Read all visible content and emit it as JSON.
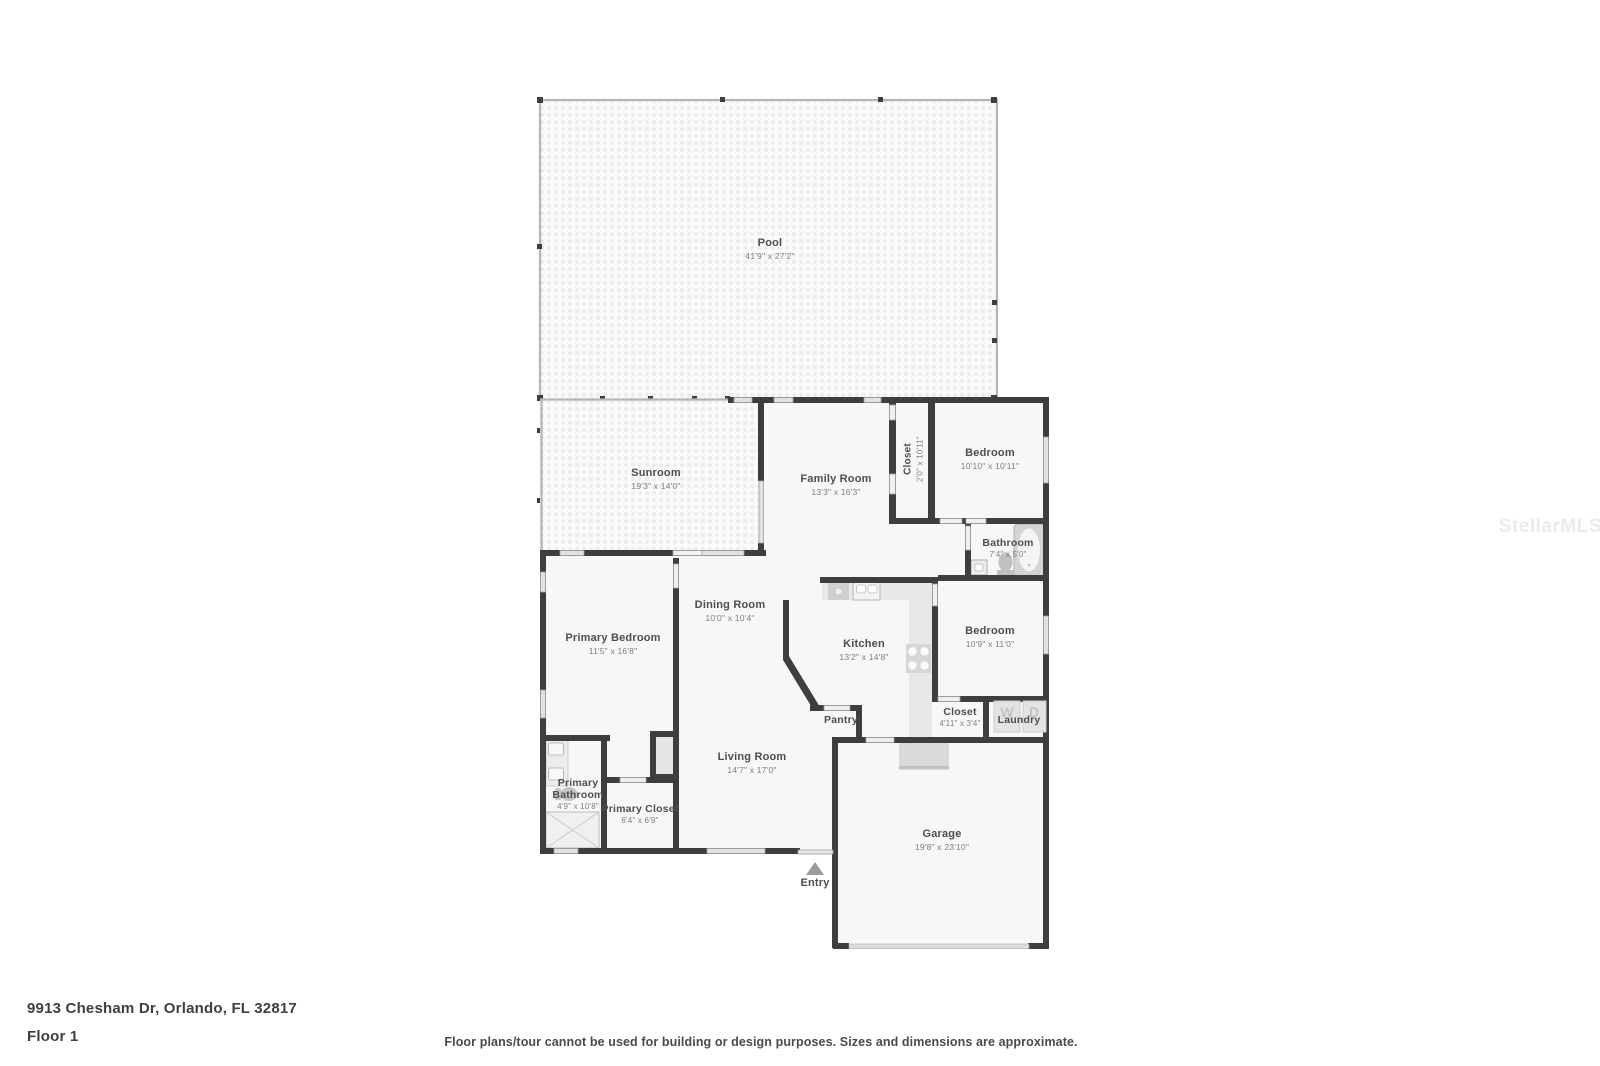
{
  "address": "9913 Chesham Dr, Orlando, FL 32817",
  "floor_label": "Floor 1",
  "disclaimer": "Floor plans/tour cannot be used for building or design purposes. Sizes and dimensions are approximate.",
  "watermark": "StellarMLS",
  "entry": {
    "label": "Entry"
  },
  "rooms": {
    "pool": {
      "name": "Pool",
      "dims": "41'9\" x 27'2\""
    },
    "sunroom": {
      "name": "Sunroom",
      "dims": "19'3\" x 14'0\""
    },
    "family_room": {
      "name": "Family Room",
      "dims": "13'3\" x 16'3\""
    },
    "hall_closet": {
      "name": "Closet",
      "dims": "2'0\" x 10'11\""
    },
    "bedroom_1": {
      "name": "Bedroom",
      "dims": "10'10\" x 10'11\""
    },
    "bathroom": {
      "name": "Bathroom",
      "dims": "7'4\" x 5'0\""
    },
    "bedroom_2": {
      "name": "Bedroom",
      "dims": "10'9\" x 11'0\""
    },
    "dining_room": {
      "name": "Dining Room",
      "dims": "10'0\" x 10'4\""
    },
    "kitchen": {
      "name": "Kitchen",
      "dims": "13'2\" x 14'8\""
    },
    "primary_bedroom": {
      "name": "Primary Bedroom",
      "dims": "11'5\" x 16'8\""
    },
    "pantry": {
      "name": "Pantry"
    },
    "bedroom_closet": {
      "name": "Closet",
      "dims": "4'11\" x 3'4\""
    },
    "laundry": {
      "name": "Laundry",
      "washer": "W",
      "dryer": "D"
    },
    "living_room": {
      "name": "Living Room",
      "dims": "14'7\" x 17'0\""
    },
    "primary_bathroom": {
      "name": "Primary Bathroom",
      "dims": "4'9\" x 10'8\""
    },
    "primary_closet": {
      "name": "Primary Closet",
      "dims": "6'4\" x 6'9\""
    },
    "garage": {
      "name": "Garage",
      "dims": "19'8\" x 23'10\""
    }
  },
  "colors": {
    "wall": "#3e3e3e",
    "window": "#e2e2e2",
    "room_fill": "#f7f7f7",
    "enclosure": "#b5b5b5",
    "label_text": "#4e4e4e",
    "dims_text": "#7e7e7e"
  }
}
